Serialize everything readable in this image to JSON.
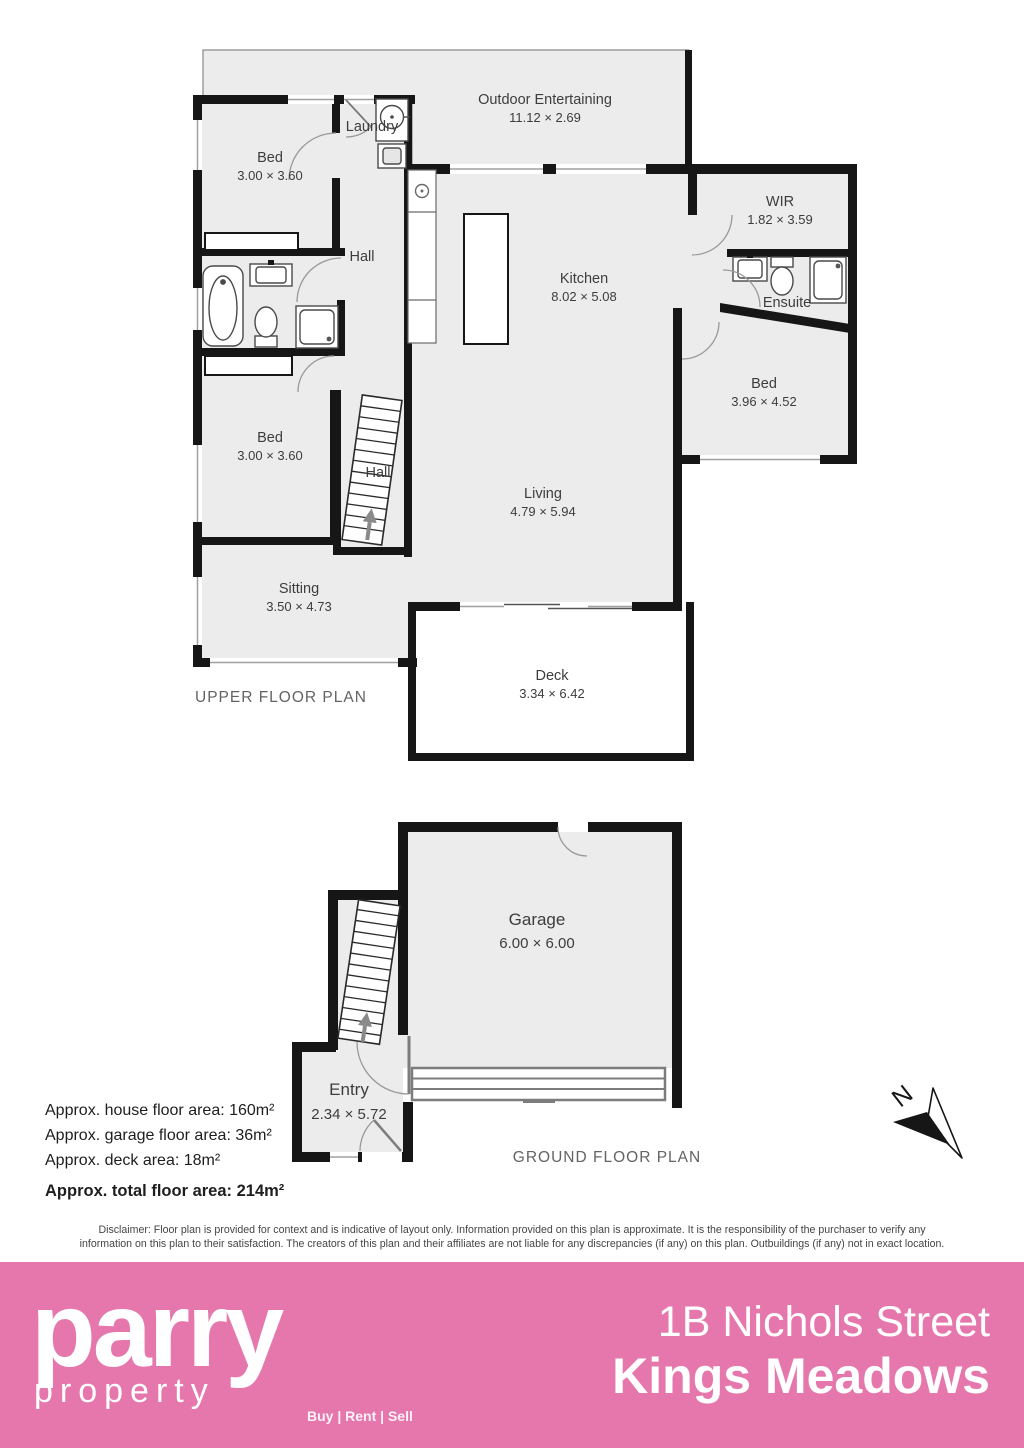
{
  "colors": {
    "wall": "#161616",
    "floor": "#ececec",
    "accent_pink": "#e677ac",
    "fixture_stroke": "#4a4a4a",
    "door_arc": "#999999"
  },
  "upper_floor": {
    "title": "UPPER FLOOR PLAN",
    "rooms": {
      "outdoor": {
        "name": "Outdoor Entertaining",
        "dims": "11.12 × 2.69"
      },
      "bed1": {
        "name": "Bed",
        "dims": "3.00 × 3.60"
      },
      "laundry": {
        "name": "Laundry"
      },
      "hall_upper": {
        "name": "Hall"
      },
      "hall_stairs": {
        "name": "Hall"
      },
      "wir": {
        "name": "WIR",
        "dims": "1.82 × 3.59"
      },
      "kitchen": {
        "name": "Kitchen",
        "dims": "8.02 × 5.08"
      },
      "ensuite": {
        "name": "Ensuite"
      },
      "bed2": {
        "name": "Bed",
        "dims": "3.96 × 4.52"
      },
      "bed3": {
        "name": "Bed",
        "dims": "3.00 × 3.60"
      },
      "living": {
        "name": "Living",
        "dims": "4.79 × 5.94"
      },
      "sitting": {
        "name": "Sitting",
        "dims": "3.50 × 4.73"
      },
      "deck": {
        "name": "Deck",
        "dims": "3.34 × 6.42"
      }
    }
  },
  "ground_floor": {
    "title": "GROUND FLOOR PLAN",
    "rooms": {
      "garage": {
        "name": "Garage",
        "dims": "6.00 × 6.00"
      },
      "entry": {
        "name": "Entry",
        "dims": "2.34 × 5.72"
      }
    }
  },
  "compass": {
    "label": "N"
  },
  "areas": {
    "house": "Approx. house floor area: 160m²",
    "garage": "Approx. garage floor area: 36m²",
    "deck": "Approx. deck area: 18m²",
    "total": "Approx. total floor area: 214m²"
  },
  "disclaimer": "Disclaimer: Floor plan is provided for context and is indicative of layout only. Information provided on this plan is approximate. It is the responsibility of the purchaser to verify any information on this plan to their satisfaction. The creators of this plan and their affiliates are not liable for any discrepancies (if any) on this plan. Outbuildings (if any) not in exact location.",
  "footer": {
    "brand_name": "parry",
    "brand_sub": "property",
    "tagline": "Buy | Rent | Sell",
    "address_line1": "1B Nichols Street",
    "address_line2": "Kings Meadows"
  }
}
